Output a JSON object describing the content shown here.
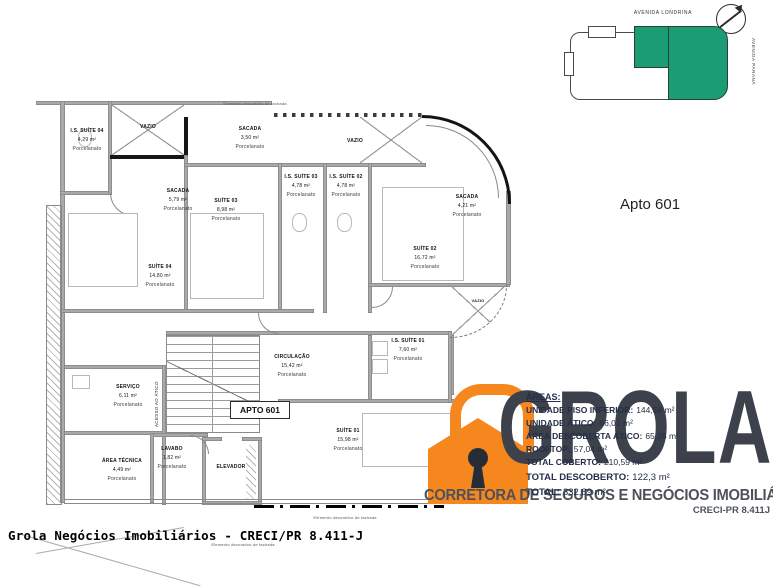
{
  "colors": {
    "accent_green": "#1a9c74",
    "logo_orange": "#f6871f",
    "logo_dark": "#3c414b"
  },
  "header": {
    "apto_label": "Apto 601"
  },
  "sitemap": {
    "street_top": "AVENIDA LONDRINA",
    "street_right": "AVENIDA PARANÁ"
  },
  "plan": {
    "apto_box": "APTO 601",
    "stairs_label": "ACESSO AO ÁTICO",
    "facade_note": "Elemento decorativo de fachada",
    "rooms": [
      {
        "name": "I.S. SUÍTE 04",
        "area": "4,29 m²",
        "finish": "Porcelanato"
      },
      {
        "name": "VAZIO"
      },
      {
        "name": "SACADA",
        "area": "3,50 m²",
        "finish": "Porcelanato"
      },
      {
        "name": "VAZIO"
      },
      {
        "name": "SACADA",
        "area": "5,79 m²",
        "finish": "Porcelanato"
      },
      {
        "name": "SUÍTE 03",
        "area": "8,98 m²",
        "finish": "Porcelanato"
      },
      {
        "name": "I.S. SUÍTE 03",
        "area": "4,78 m²",
        "finish": "Porcelanato"
      },
      {
        "name": "I.S. SUÍTE 02",
        "area": "4,78 m²",
        "finish": "Porcelanato"
      },
      {
        "name": "SUÍTE 02",
        "area": "16,72 m²",
        "finish": "Porcelanato"
      },
      {
        "name": "SACADA",
        "area": "4,21 m²",
        "finish": "Porcelanato"
      },
      {
        "name": "SUÍTE 04",
        "area": "14,80 m²",
        "finish": "Porcelanato"
      },
      {
        "name": "CIRCULAÇÃO",
        "area": "15,42 m²",
        "finish": "Porcelanato"
      },
      {
        "name": "VAZIO"
      },
      {
        "name": "I.S. SUÍTE 01",
        "area": "7,60 m²",
        "finish": "Porcelanato"
      },
      {
        "name": "SUÍTE 01",
        "area": "15,98 m²",
        "finish": "Porcelanato"
      },
      {
        "name": "SERVIÇO",
        "area": "6,11 m²",
        "finish": "Porcelanato"
      },
      {
        "name": "ÁREA TÉCNICA",
        "area": "4,49 m²",
        "finish": "Porcelanato"
      },
      {
        "name": "LAVABO",
        "area": "1,82 m²",
        "finish": "Porcelanato"
      },
      {
        "name": "ELEVADOR"
      }
    ]
  },
  "areas_panel": {
    "title": "ÁREAS:",
    "lines": [
      {
        "label": "UNIDADE PISO INFERIOR:",
        "value": "144,58 m²"
      },
      {
        "label": "UNIDADE ÁTICO:",
        "value": "66,01 m²"
      },
      {
        "label": "ÁREA DESCOBERTA ÁTICO:",
        "value": "65,26 m²"
      },
      {
        "label": "ROOFTOP:",
        "value": "57,04 m²"
      },
      {
        "label": "TOTAL COBERTO:",
        "value": "210,59 m²"
      },
      {
        "label": "TOTAL DESCOBERTO:",
        "value": "122,3 m²"
      },
      {
        "label": "TOTAL:",
        "value": "332,89 m²"
      }
    ]
  },
  "logo": {
    "name": "GROLA",
    "tagline": "CORRETORA DE SEGUROS E NEGÓCIOS IMOBILIÁRIOS",
    "creci": "CRECI-PR 8.411J"
  },
  "footer": {
    "text": "Grola Negócios Imobiliários - CRECI/PR 8.411-J"
  }
}
